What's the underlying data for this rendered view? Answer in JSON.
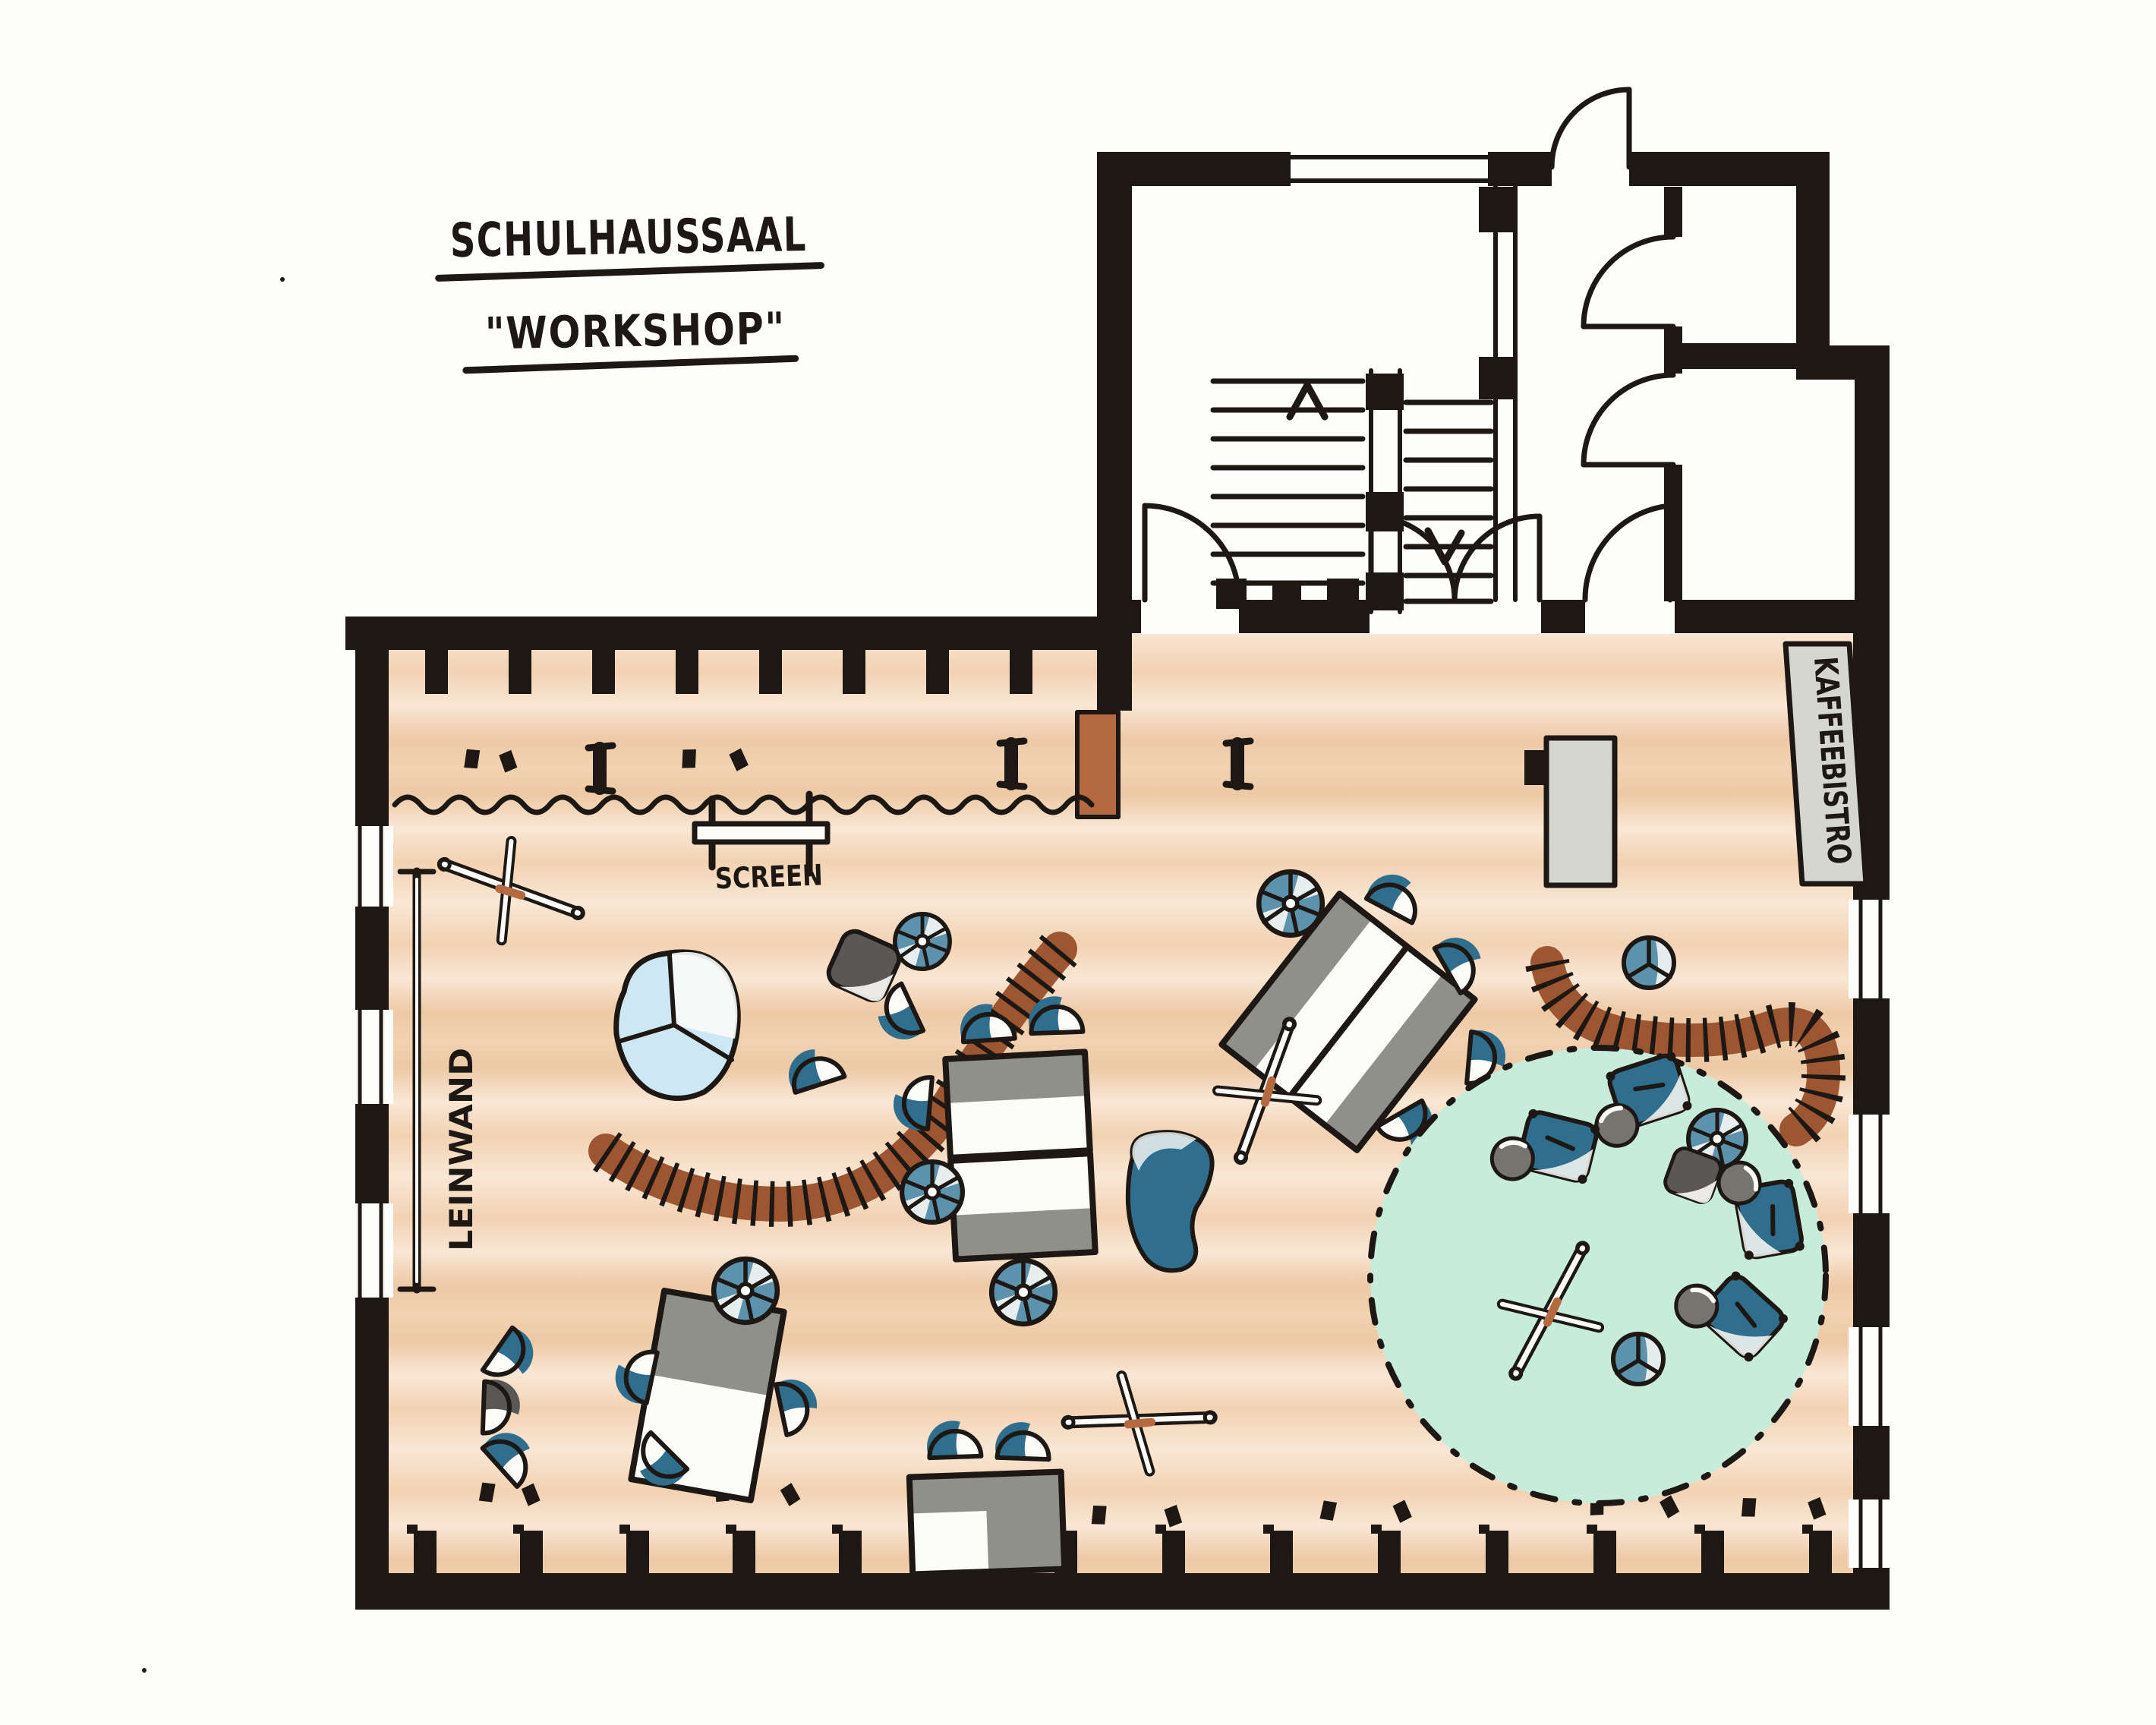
{
  "title": {
    "line1": "SCHULHAUSSAAL",
    "line2": "\"WORKSHOP\""
  },
  "room_labels": {
    "screen": "SCREEN",
    "leinwand": "LEINWAND",
    "kaffeebistro": "KAFFEEBISTRO"
  },
  "colors": {
    "ink": "#1d1813",
    "paper": "#fdfdfb",
    "white": "#fbfbf7",
    "floor": "#f2d2b2",
    "floor-light": "#f9e7d5",
    "floor-deep": "#edc9a5",
    "blue": "#2f6e8d",
    "blue-mid": "#5d92ac",
    "blue-light": "#cde8f4",
    "mint": "#c7ecd9",
    "brown": "#9c5632",
    "brown-light": "#b4693f",
    "gray": "#8f9089",
    "gray-light": "#d6d6d1",
    "gray-mid": "#75746f",
    "gray-dark": "#595854"
  }
}
